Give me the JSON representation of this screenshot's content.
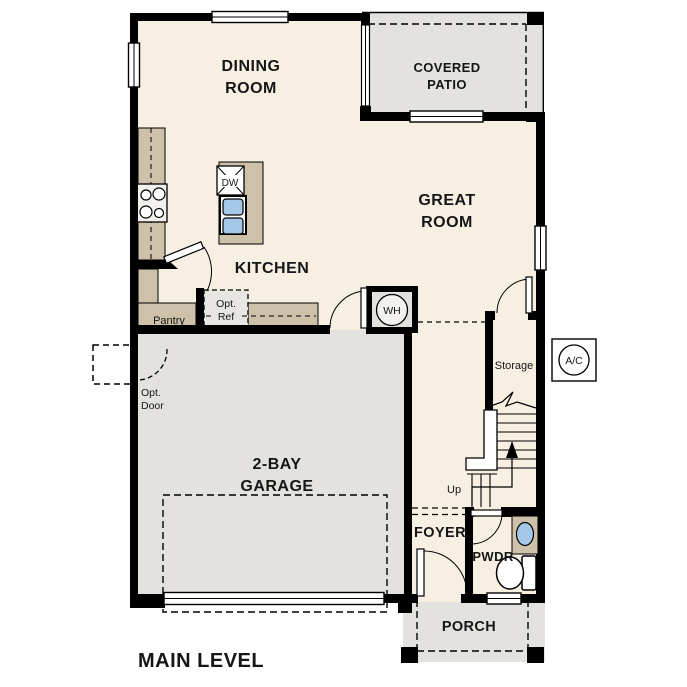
{
  "plan_title": "MAIN LEVEL",
  "colors": {
    "floor": "#f7efe2",
    "outdoor": "#e3e2df",
    "counter": "#cdc1a9",
    "sink_blue": "#a5c8e9",
    "wall": "#000000"
  },
  "rooms": {
    "dining": {
      "lines": [
        "DINING",
        "ROOM"
      ]
    },
    "patio": {
      "lines": [
        "COVERED",
        "PATIO"
      ]
    },
    "great": {
      "lines": [
        "GREAT",
        "ROOM"
      ]
    },
    "kitchen": {
      "label": "KITCHEN"
    },
    "garage": {
      "lines": [
        "2-BAY",
        "GARAGE"
      ]
    },
    "foyer": {
      "label": "FOYER"
    },
    "pwdr": {
      "label": "PWDR"
    },
    "porch": {
      "label": "PORCH"
    },
    "storage": {
      "label": "Storage"
    },
    "pantry": {
      "label": "Pantry"
    }
  },
  "annotations": {
    "opt_ref": {
      "lines": [
        "Opt.",
        "Ref"
      ]
    },
    "opt_door": {
      "lines": [
        "Opt.",
        "Door"
      ]
    },
    "up": "Up",
    "wh": "WH",
    "ac": "A/C",
    "dw": "DW"
  }
}
